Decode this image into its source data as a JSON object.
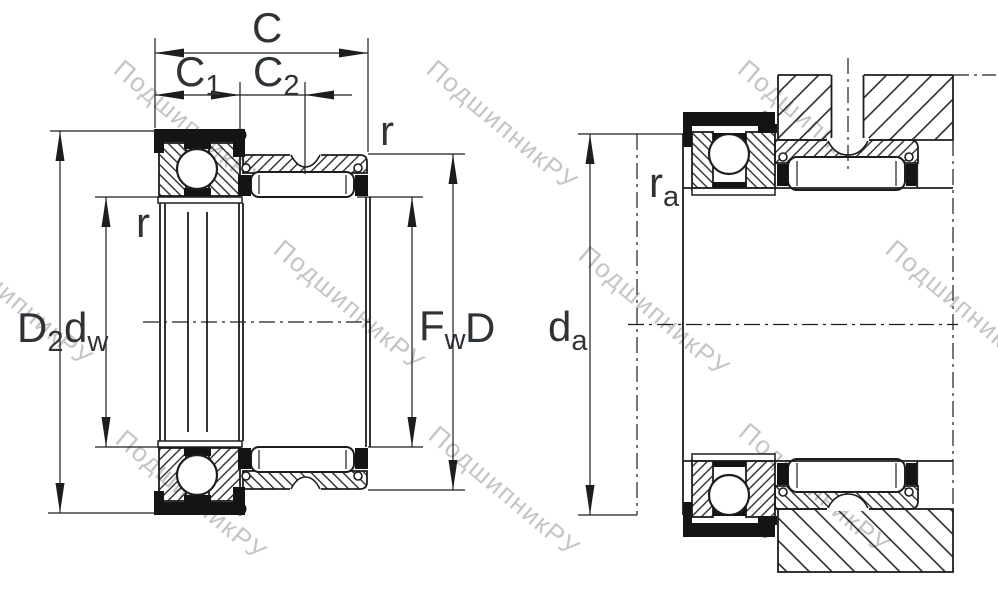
{
  "watermark": {
    "text": "ПодшипникРУ"
  },
  "labels": {
    "c": {
      "main": "C",
      "sub": ""
    },
    "c1": {
      "main": "C",
      "sub": "1"
    },
    "c2": {
      "main": "C",
      "sub": "2"
    },
    "r_top": {
      "main": "r",
      "sub": ""
    },
    "r_left": {
      "main": "r",
      "sub": ""
    },
    "d2": {
      "main": "D",
      "sub": "2"
    },
    "dw": {
      "main": "d",
      "sub": "w"
    },
    "fw": {
      "main": "F",
      "sub": "w"
    },
    "d": {
      "main": "D",
      "sub": ""
    },
    "ra": {
      "main": "r",
      "sub": "a"
    },
    "da": {
      "main": "d",
      "sub": "a"
    }
  },
  "colors": {
    "line": "#1d1d1d",
    "label": "#2e3338",
    "watermark": "#aeaeae",
    "background": "#ffffff"
  }
}
